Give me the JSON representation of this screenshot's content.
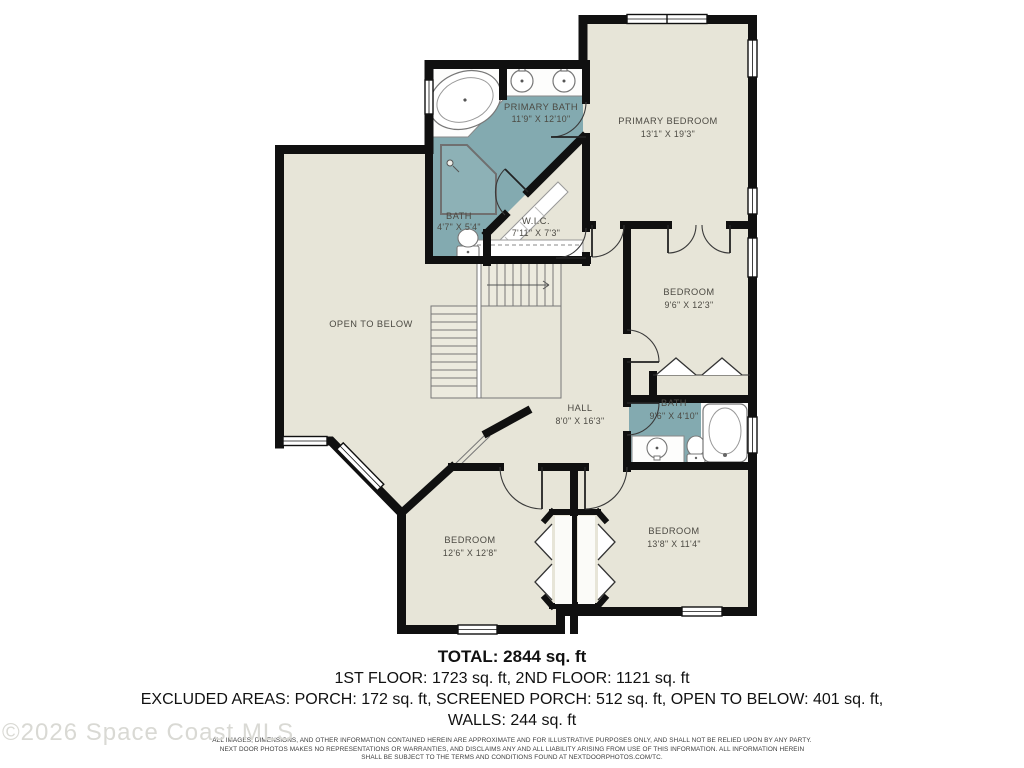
{
  "watermark": "©2026 Space Coast MLS",
  "rooms": {
    "primary_bath": {
      "name": "PRIMARY BATH",
      "dims": "11'9\" X 12'10\""
    },
    "primary_bedroom": {
      "name": "PRIMARY BEDROOM",
      "dims": "13'1\" X 19'3\""
    },
    "bath_small": {
      "name": "BATH",
      "dims": "4'7\" X 5'4\""
    },
    "wic": {
      "name": "W.I.C.",
      "dims": "7'11\" X 7'3\""
    },
    "bedroom_upper": {
      "name": "BEDROOM",
      "dims": "9'6\" X 12'3\""
    },
    "hall": {
      "name": "HALL",
      "dims": "8'0\" X 16'3\""
    },
    "bath_hall": {
      "name": "BATH",
      "dims": "9'6\" X 4'10\""
    },
    "bedroom_left": {
      "name": "BEDROOM",
      "dims": "12'6\" X 12'8\""
    },
    "bedroom_right": {
      "name": "BEDROOM",
      "dims": "13'8\" X 11'4\""
    },
    "open_to_below": {
      "name": "OPEN TO BELOW"
    }
  },
  "summary": {
    "total": "TOTAL: 2844 sq. ft",
    "floors": "1ST FLOOR: 1723 sq. ft, 2ND FLOOR: 1121 sq. ft",
    "excluded": "EXCLUDED AREAS: PORCH: 172 sq. ft, SCREENED PORCH: 512 sq. ft, OPEN TO BELOW: 401 sq. ft,",
    "walls": "WALLS: 244 sq. ft"
  },
  "disclaimer": {
    "line1": "ALL IMAGES, DIMENSIONS, AND OTHER INFORMATION CONTAINED HEREIN ARE APPROXIMATE AND FOR ILLUSTRATIVE PURPOSES ONLY, AND SHALL NOT BE RELIED UPON BY ANY PARTY.",
    "line2": "NEXT DOOR PHOTOS MAKES NO REPRESENTATIONS OR WARRANTIES, AND DISCLAIMS ANY AND ALL LIABILITY ARISING FROM USE OF THIS INFORMATION. ALL INFORMATION HEREIN",
    "line3": "SHALL BE SUBJECT TO THE TERMS AND CONDITIONS FOUND AT NEXTDOORPHOTOS.COM/TC."
  },
  "colors": {
    "floor": "#e7e5d8",
    "bath_floor": "#83aab0",
    "wall": "#101010"
  }
}
